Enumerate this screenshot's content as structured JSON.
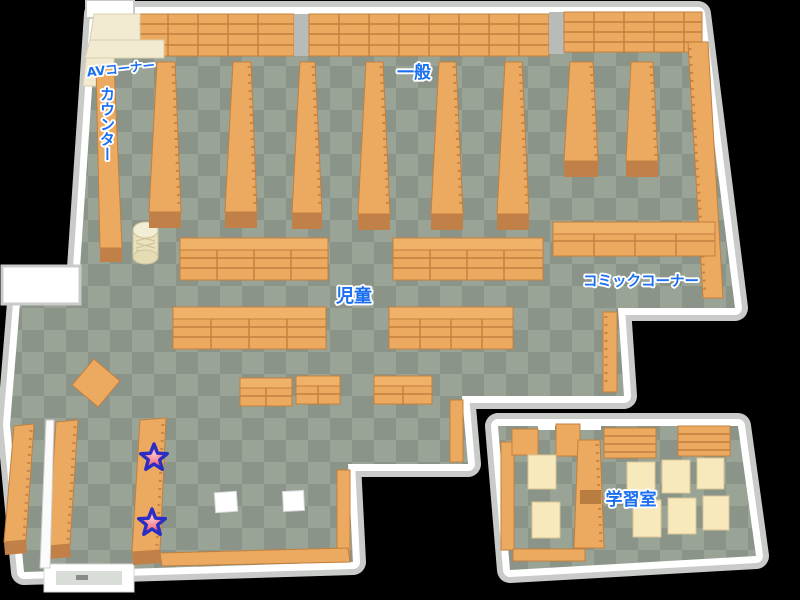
{
  "map": {
    "areas": {
      "av_corner": {
        "label": "AVコーナー"
      },
      "counter": {
        "label": "カウンター"
      },
      "general": {
        "label": "一般"
      },
      "children": {
        "label": "児童"
      },
      "comic_corner": {
        "label": "コミックコーナー"
      },
      "study_room": {
        "label": "学習室"
      }
    },
    "markers": {
      "stars": [
        {
          "name": "star-marker-upper",
          "x": 154,
          "y": 458
        },
        {
          "name": "star-marker-lower",
          "x": 152,
          "y": 523
        }
      ]
    },
    "colors": {
      "background": "#000000",
      "floor_tile_light": "#99a396",
      "floor_tile_dark": "#8a9489",
      "wall": "#ffffff",
      "wall_shadow": "#c9cbc9",
      "bookshelf_orange": "#ecaa61",
      "bookshelf_front": "#c28049",
      "av_counter_cream": "#f2ebd2",
      "desk_cream": "#f8e9bd",
      "label_blue": "#1a6ef0",
      "label_outline": "#ffffff",
      "star_red": "#ef4b5c",
      "star_outline": "#2a2ec4"
    }
  }
}
